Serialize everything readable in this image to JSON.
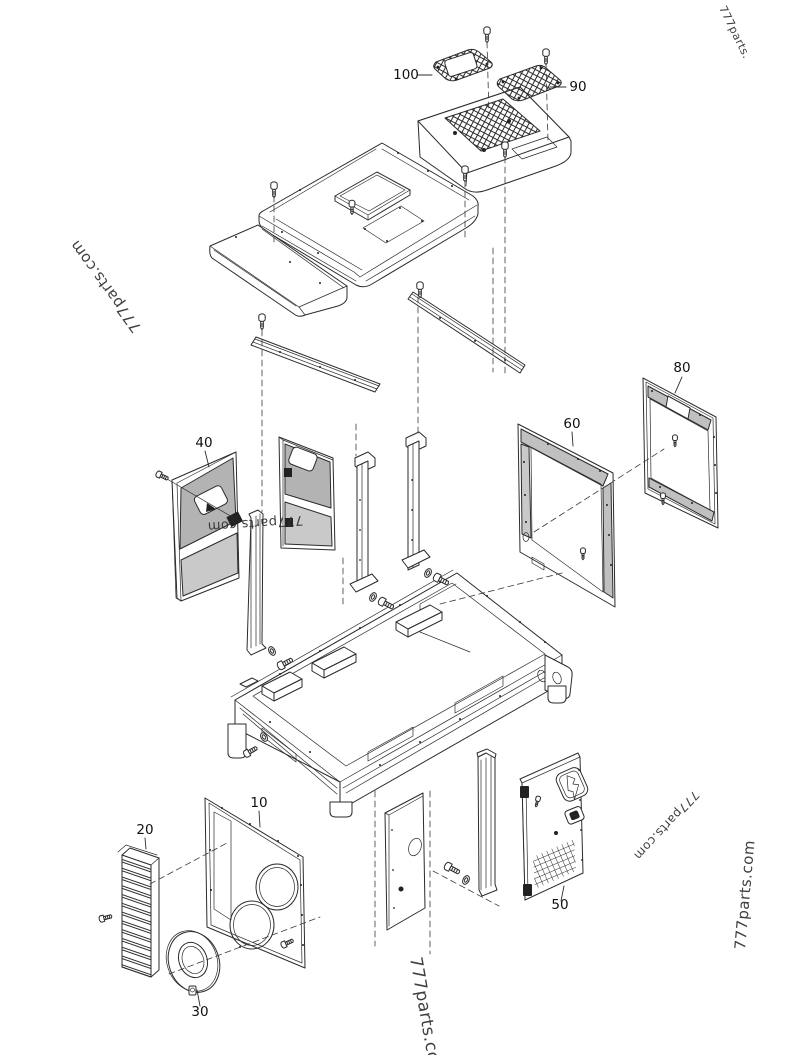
{
  "diagram": {
    "type": "exploded-parts-diagram",
    "subject": "generator enclosure canopy panels and doors",
    "background": "#ffffff",
    "line_color": "#2b2b2b",
    "panel_gray_dark": "#b3b3b3",
    "panel_gray_light": "#c9c9c9",
    "callouts": [
      {
        "part": "100"
      },
      {
        "part": "90"
      },
      {
        "part": "80"
      },
      {
        "part": "60"
      },
      {
        "part": "40"
      },
      {
        "part": "10"
      },
      {
        "part": "20"
      },
      {
        "part": "50"
      },
      {
        "part": "30"
      }
    ],
    "watermarks": [
      {
        "text": "777parts.",
        "color": "#2f2f2f",
        "size": 11,
        "rotate": 64
      },
      {
        "text": "777parts.com",
        "color": "#2f2f2f",
        "size": 15,
        "rotate": -126
      },
      {
        "text": "777parts.com",
        "color": "#2f2f2f",
        "size": 13,
        "rotate": 176
      },
      {
        "text": "777parts.com",
        "color": "#2f2f2f",
        "size": 12,
        "rotate": 133
      },
      {
        "text": "777parts.com",
        "color": "#2f2f2f",
        "size": 15,
        "rotate": -85
      },
      {
        "text": "777parts.com",
        "color": "#2f2f2f",
        "size": 17,
        "rotate": 80
      }
    ]
  }
}
